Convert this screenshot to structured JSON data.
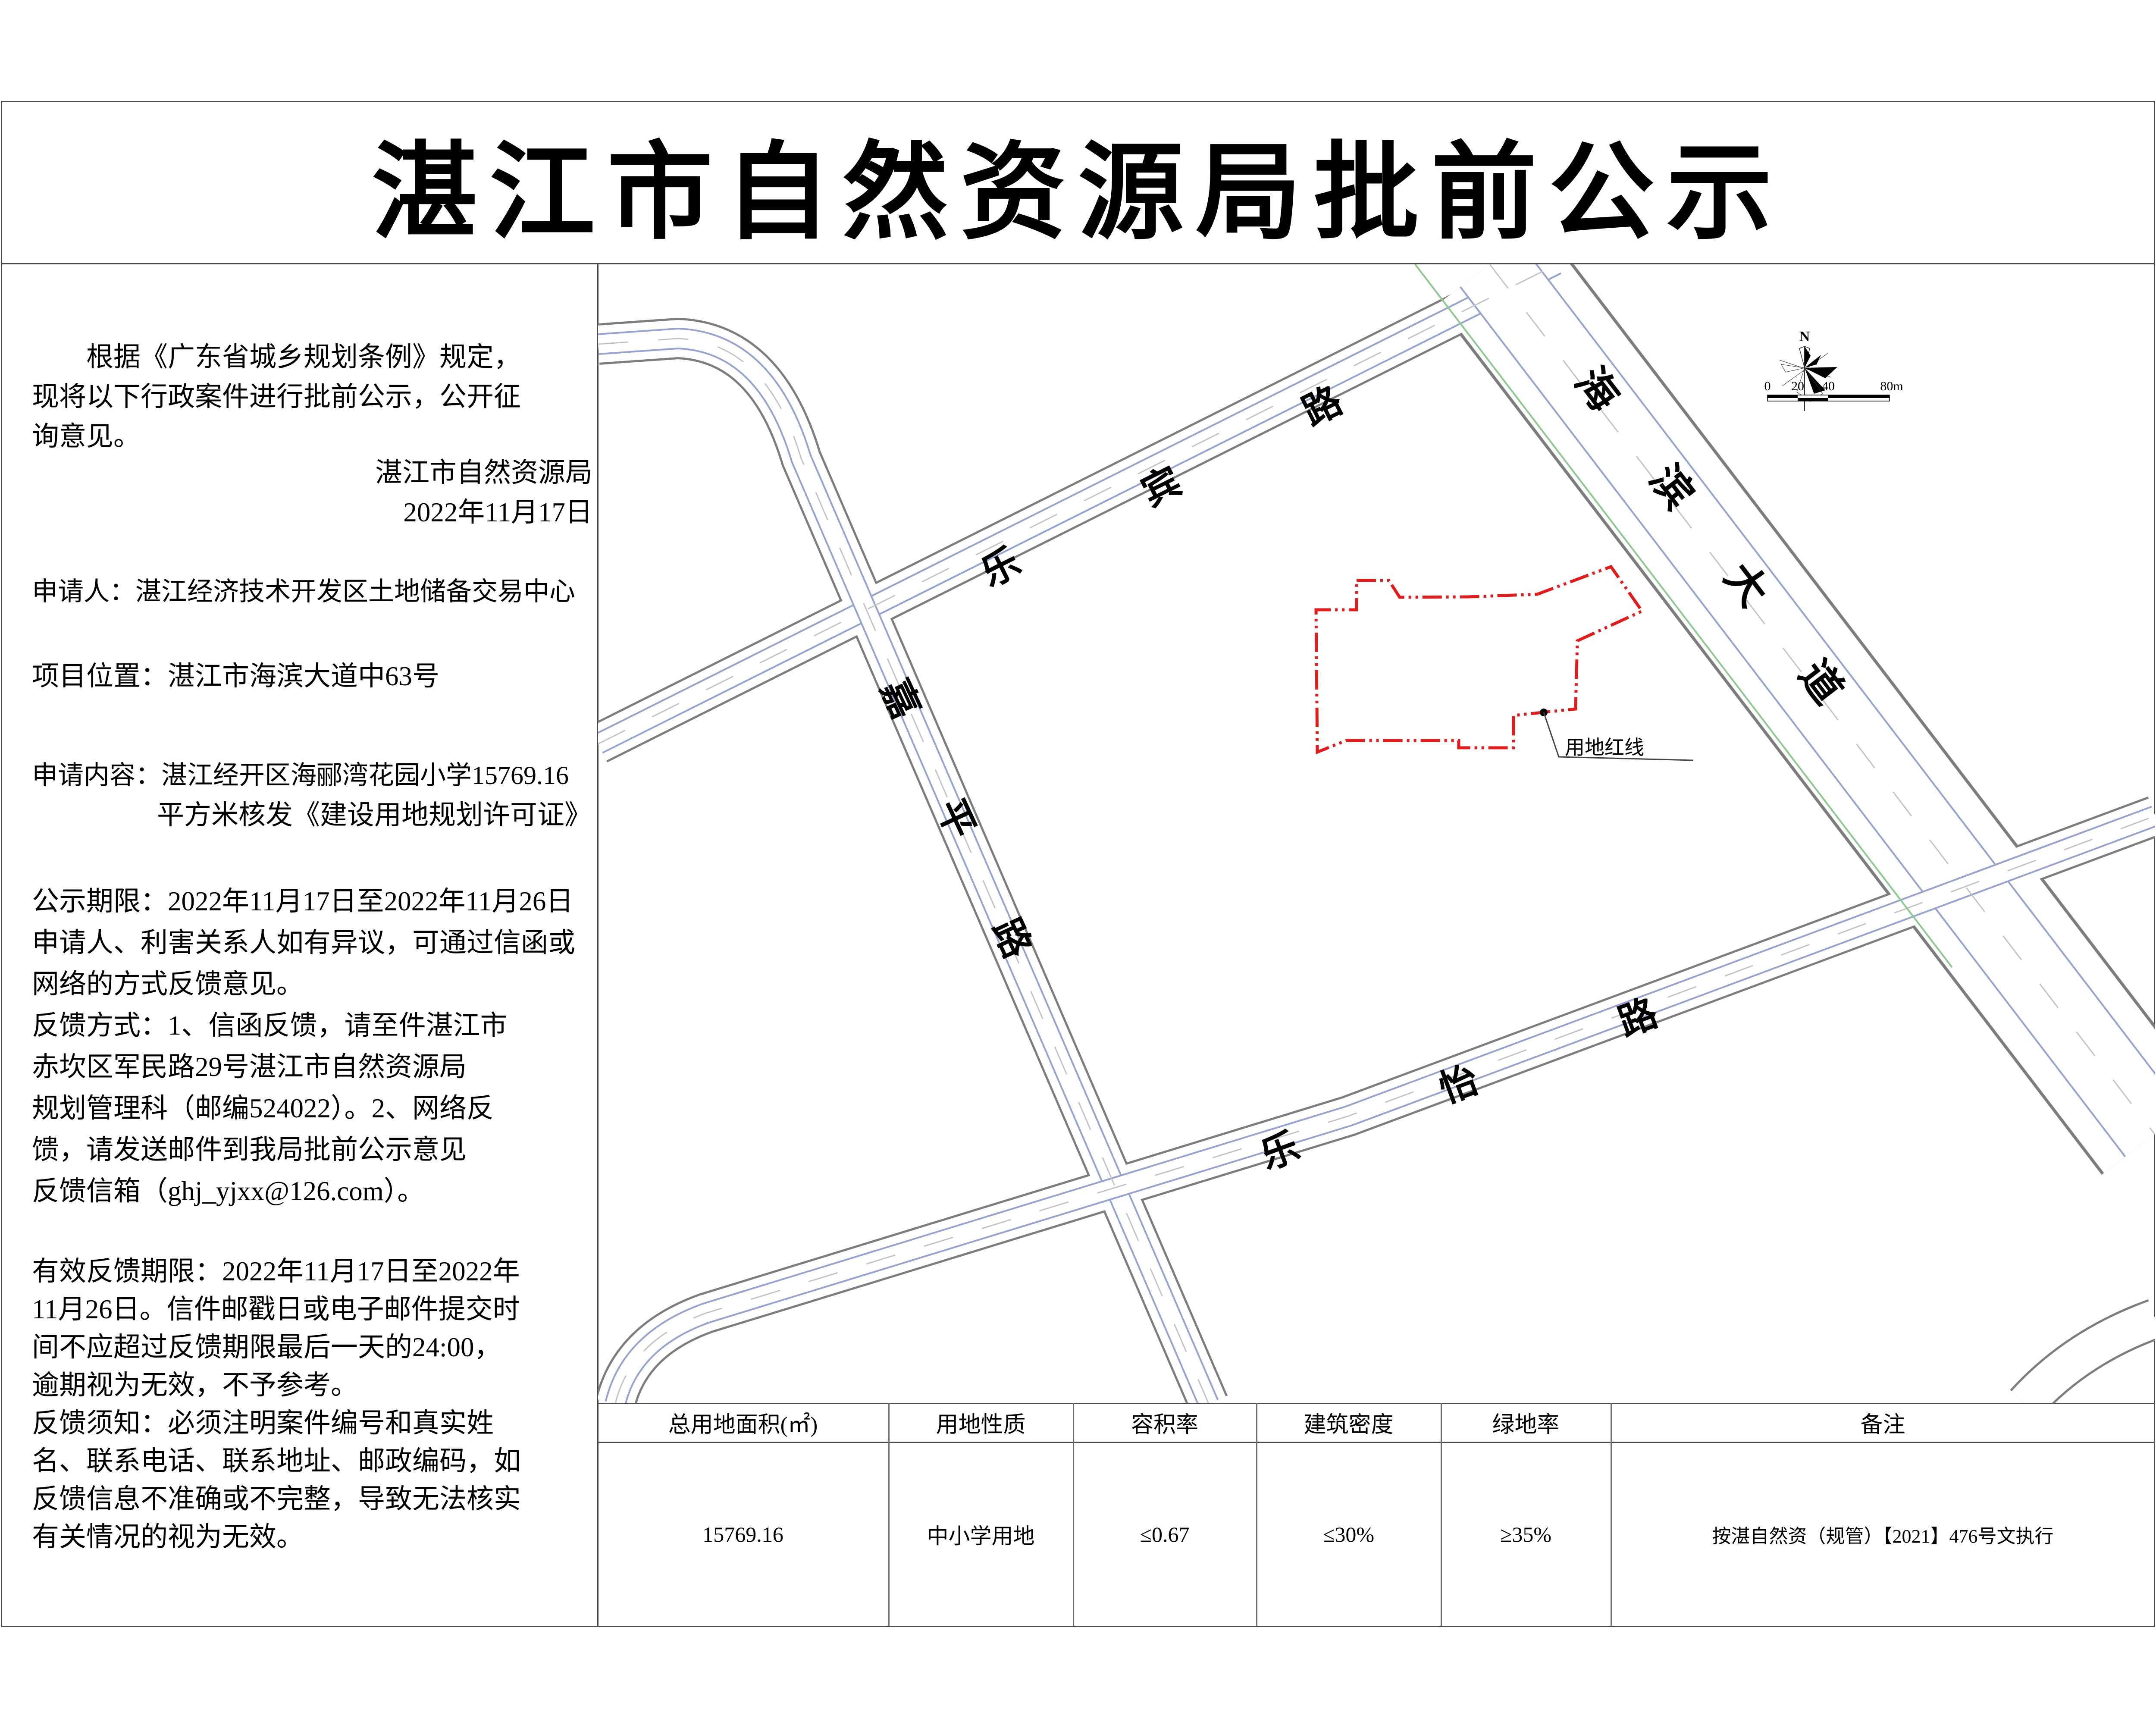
{
  "title": "湛江市自然资源局批前公示",
  "notice": {
    "p1": {
      "l1": "根据《广东省城乡规划条例》规定，",
      "l2": "现将以下行政案件进行批前公示，公开征",
      "l3": "询意见。"
    },
    "signature": {
      "org": "湛江市自然资源局",
      "date": "2022年11月17日"
    },
    "applicant": "申请人：湛江经济技术开发区土地储备交易中心",
    "location": "项目位置：湛江市海滨大道中63号",
    "content": {
      "l1": "申请内容：湛江经开区海郦湾花园小学15769.16",
      "l2": "平方米核发《建设用地规划许可证》"
    },
    "period": {
      "l1": "公示期限：2022年11月17日至2022年11月26日",
      "l2": "申请人、利害关系人如有异议，可通过信函或",
      "l3": "网络的方式反馈意见。",
      "l4": "反馈方式：1、信函反馈，请至件湛江市",
      "l5": "赤坎区军民路29号湛江市自然资源局",
      "l6": "规划管理科（邮编524022）。2、网络反",
      "l7": "馈，请发送邮件到我局批前公示意见",
      "l8": "反馈信箱（ghj_yjxx@126.com）。"
    },
    "validity": {
      "l1": "有效反馈期限：2022年11月17日至2022年",
      "l2": "11月26日。信件邮戳日或电子邮件提交时",
      "l3": "间不应超过反馈期限最后一天的24:00，",
      "l4": "逾期视为无效，不予参考。",
      "l5": "反馈须知：必须注明案件编号和真实姓",
      "l6": "名、联系电话、联系地址、邮政编码，如",
      "l7": "反馈信息不准确或不完整，导致无法核实",
      "l8": "有关情况的视为无效。"
    }
  },
  "map": {
    "roads": {
      "lebin": "乐宾路",
      "haibin": "海滨大道",
      "jiaping": "嘉平路",
      "leyi": "乐怡路"
    },
    "parcel_label": "用地红线",
    "compass_n": "N",
    "scale_ticks": {
      "t0": "0",
      "t20": "20",
      "t40": "40",
      "t80": "80m"
    }
  },
  "table": {
    "headers": [
      "总用地面积(㎡)",
      "用地性质",
      "容积率",
      "建筑密度",
      "绿地率",
      "备注"
    ],
    "row": [
      "15769.16",
      "中小学用地",
      "≤0.67",
      "≤30%",
      "≥35%",
      "按湛自然资（规管）【2021】476号文执行"
    ]
  },
  "colors": {
    "parcel_red": "#e11c1c",
    "road_blue": "#97a3cf",
    "green_boundary": "#8fc98f",
    "frame_gray": "#4a4a4a"
  }
}
